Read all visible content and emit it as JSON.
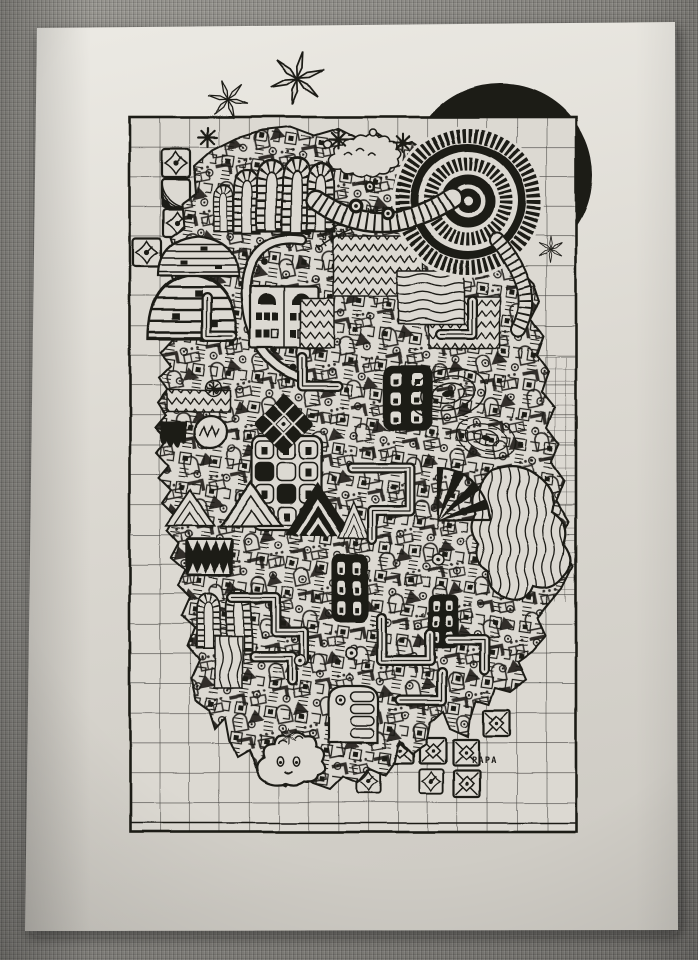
{
  "photo": {
    "subject": "black ink doodle drawing on white paper lying on grey woven fabric",
    "signature": "PAPA",
    "palette": {
      "ink": "#1d1b18",
      "paper": "#dcd9d2",
      "fabric": "#7e7c79"
    },
    "motifs": [
      "grid-frame",
      "eclipse-disc",
      "bullseye-target",
      "sparkle-stars",
      "finger-arches",
      "caterpillar-bands",
      "window-buildings",
      "zigzag-textures",
      "chevron-mountains",
      "diamond-eye-tiles",
      "maze-pipes",
      "contour-doodles",
      "blob-creature",
      "artist-signature"
    ]
  }
}
